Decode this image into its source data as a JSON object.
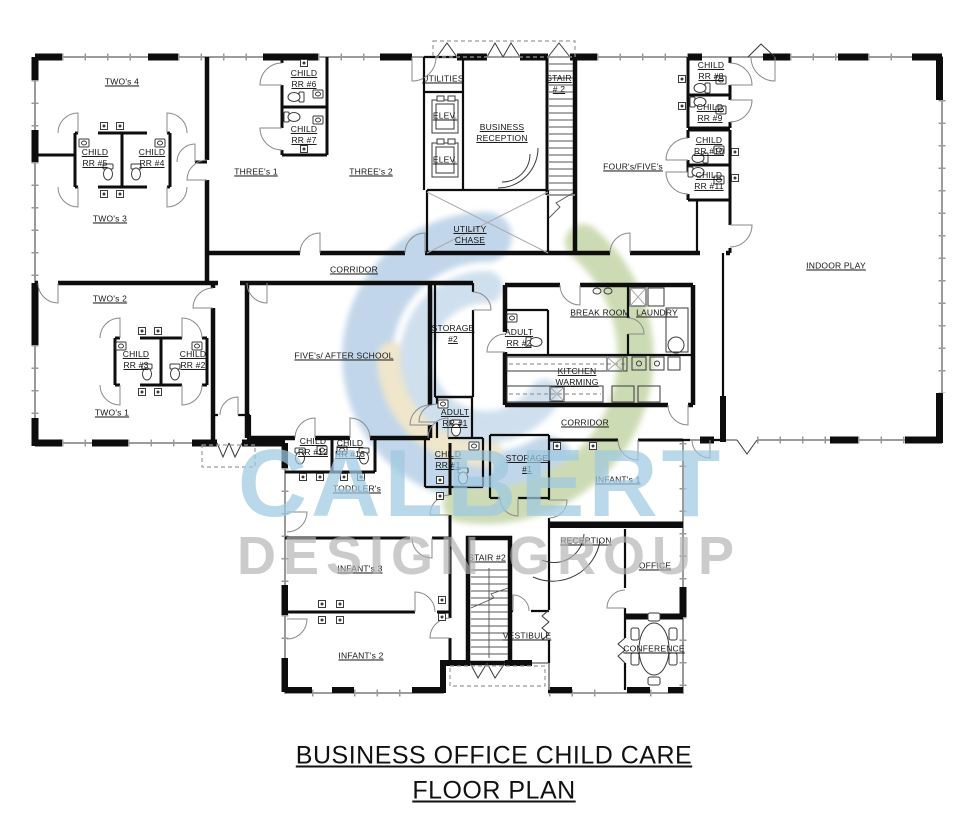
{
  "title": {
    "line1": "BUSINESS OFFICE CHILD CARE",
    "line2": "FLOOR PLAN"
  },
  "watermark": {
    "name": "CALBERT",
    "subtitle": "DESIGN GROUP",
    "logo_colors": {
      "blue": "#8fb6d9",
      "green": "#a6bf78",
      "tan": "#e2d2a2"
    }
  },
  "rooms": {
    "twos4": {
      "label": "TWO's 4"
    },
    "twos3": {
      "label": "TWO's 3"
    },
    "twos2": {
      "label": "TWO's 2"
    },
    "twos1": {
      "label": "TWO's 1"
    },
    "child_rr5": {
      "label": "CHILD\nRR #5"
    },
    "child_rr4": {
      "label": "CHILD\nRR #4"
    },
    "child_rr3": {
      "label": "CHILD\nRR #3"
    },
    "child_rr2": {
      "label": "CHILD\nRR #2"
    },
    "child_rr6": {
      "label": "CHILD\nRR #6"
    },
    "child_rr7": {
      "label": "CHILD\nRR #7"
    },
    "child_rr8": {
      "label": "CHILD\nRR #8"
    },
    "child_rr9": {
      "label": "CHILD\nRR #9"
    },
    "child_rr10": {
      "label": "CHILD\nRR #10"
    },
    "child_rr11": {
      "label": "CHILD\nRR #11"
    },
    "child_rr12": {
      "label": "CHILD\nRR #12"
    },
    "child_rr13": {
      "label": "CHILD\nRR #13"
    },
    "child_rr1": {
      "label": "CHILD\nRR #1"
    },
    "adult_rr1": {
      "label": "ADULT\nRR #1"
    },
    "adult_rr2": {
      "label": "ADULT\nRR #2"
    },
    "threes1": {
      "label": "THREE's 1"
    },
    "threes2": {
      "label": "THREE's 2"
    },
    "utilities": {
      "label": "UTILITIES"
    },
    "elev1": {
      "label": "ELEV."
    },
    "elev2": {
      "label": "ELEV."
    },
    "business_reception": {
      "label": "BUSINESS\nRECEPTION"
    },
    "stair_top": {
      "label": "STAIR\n# 2"
    },
    "utility_chase": {
      "label": "UTILITY\nCHASE"
    },
    "fours_fives": {
      "label": "FOUR's/FIVE's"
    },
    "indoor_play": {
      "label": "INDOOR PLAY"
    },
    "corridor_upper": {
      "label": "CORRIDOR"
    },
    "corridor_lower": {
      "label": "CORRIDOR"
    },
    "fives_after_school": {
      "label": "FIVE's/ AFTER SCHOOL"
    },
    "storage2": {
      "label": "STORAGE\n#2"
    },
    "break_room": {
      "label": "BREAK ROOM"
    },
    "laundry": {
      "label": "LAUNDRY"
    },
    "kitchen_warming": {
      "label": "KITCHEN\nWARMING"
    },
    "storage1": {
      "label": "STORAGE\n#1"
    },
    "infants1": {
      "label": "INFANT's 1"
    },
    "toddlers": {
      "label": "TODDLER's"
    },
    "reception": {
      "label": "RECEPTION"
    },
    "office": {
      "label": "OFFICE"
    },
    "infants3": {
      "label": "INFANT's 3"
    },
    "stair_bottom": {
      "label": "STAIR #2"
    },
    "vestibule": {
      "label": "VESTIBULE"
    },
    "infants2": {
      "label": "INFANT's 2"
    },
    "conference": {
      "label": "CONFERENCE"
    }
  }
}
